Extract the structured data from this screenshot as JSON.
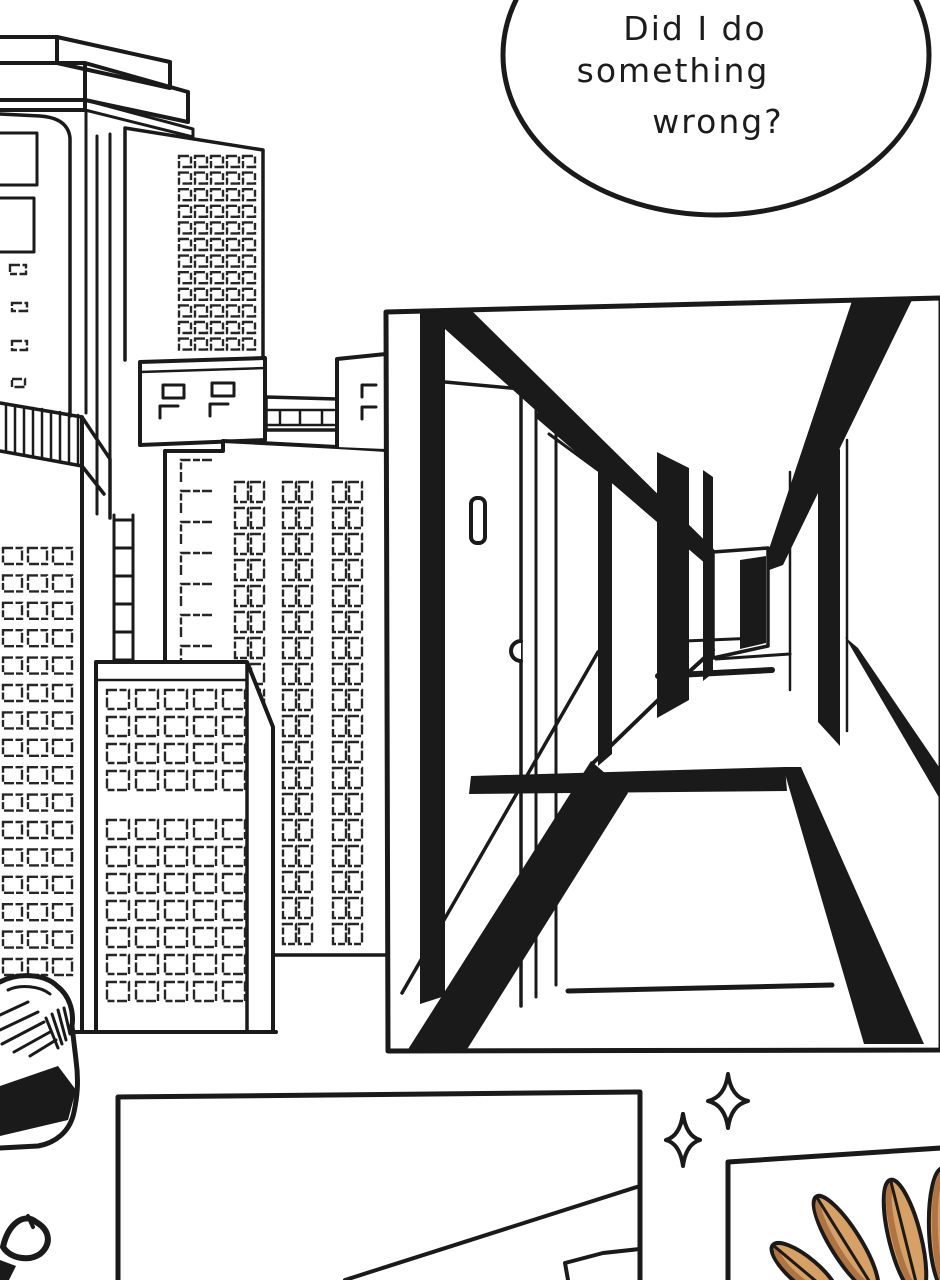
{
  "page": {
    "kind": "black-and-white comic page",
    "panel_count_visible": 3,
    "colors": {
      "ink": "#1a1a1a",
      "paper": "#ffffff",
      "feather": "#D7A065",
      "feather_shade": "#B07442"
    }
  },
  "speech_bubble": {
    "line1": "Did I do",
    "line2": "something",
    "line3": "wrong?"
  },
  "scene_labels": {
    "background": "city skyline with window grids",
    "hallway_panel": "empty apartment hallway in one-point perspective",
    "bottom_left_panel": "room corner panel (partially visible)",
    "bottom_right_panel": "tan feathered wing (partially visible)",
    "sparkles": "two four-point sparkles"
  }
}
